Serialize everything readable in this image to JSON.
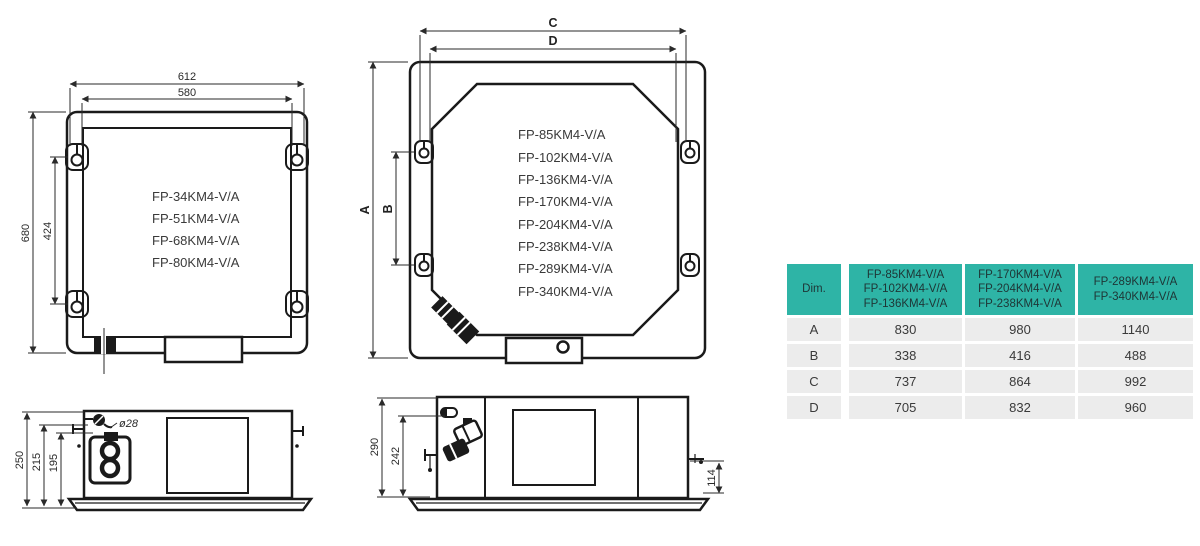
{
  "drawings": {
    "small_unit_top": {
      "models": [
        "FP-34KM4-V/A",
        "FP-51KM4-V/A",
        "FP-68KM4-V/A",
        "FP-80KM4-V/A"
      ],
      "dims": {
        "width_outer": "612",
        "width_inner": "580",
        "height_outer": "680",
        "height_inner": "424"
      }
    },
    "large_unit_top": {
      "models": [
        "FP-85KM4-V/A",
        "FP-102KM4-V/A",
        "FP-136KM4-V/A",
        "FP-170KM4-V/A",
        "FP-204KM4-V/A",
        "FP-238KM4-V/A",
        "FP-289KM4-V/A",
        "FP-340KM4-V/A"
      ],
      "dims": {
        "width_outer": "C",
        "width_inner": "D",
        "height_outer": "A",
        "height_inner": "B"
      }
    },
    "small_unit_side": {
      "dims": {
        "height_total": "250",
        "height_mid": "215",
        "height_body": "195",
        "drain_diameter": "ø28"
      }
    },
    "large_unit_side": {
      "dims": {
        "height_total": "290",
        "height_body": "242",
        "panel_offset": "114"
      }
    }
  },
  "table": {
    "header_dim": "Dim.",
    "model_groups": [
      [
        "FP-85KM4-V/A",
        "FP-102KM4-V/A",
        "FP-136KM4-V/A"
      ],
      [
        "FP-170KM4-V/A",
        "FP-204KM4-V/A",
        "FP-238KM4-V/A"
      ],
      [
        "FP-289KM4-V/A",
        "FP-340KM4-V/A"
      ]
    ],
    "rows": [
      {
        "dim": "A",
        "values": [
          "830",
          "980",
          "1140"
        ]
      },
      {
        "dim": "B",
        "values": [
          "338",
          "416",
          "488"
        ]
      },
      {
        "dim": "C",
        "values": [
          "737",
          "864",
          "992"
        ]
      },
      {
        "dim": "D",
        "values": [
          "705",
          "832",
          "960"
        ]
      }
    ]
  },
  "colors": {
    "accent_teal": "#2EB4A6",
    "row_gray": "#ECECEC",
    "line_black": "#1A1A1A"
  }
}
